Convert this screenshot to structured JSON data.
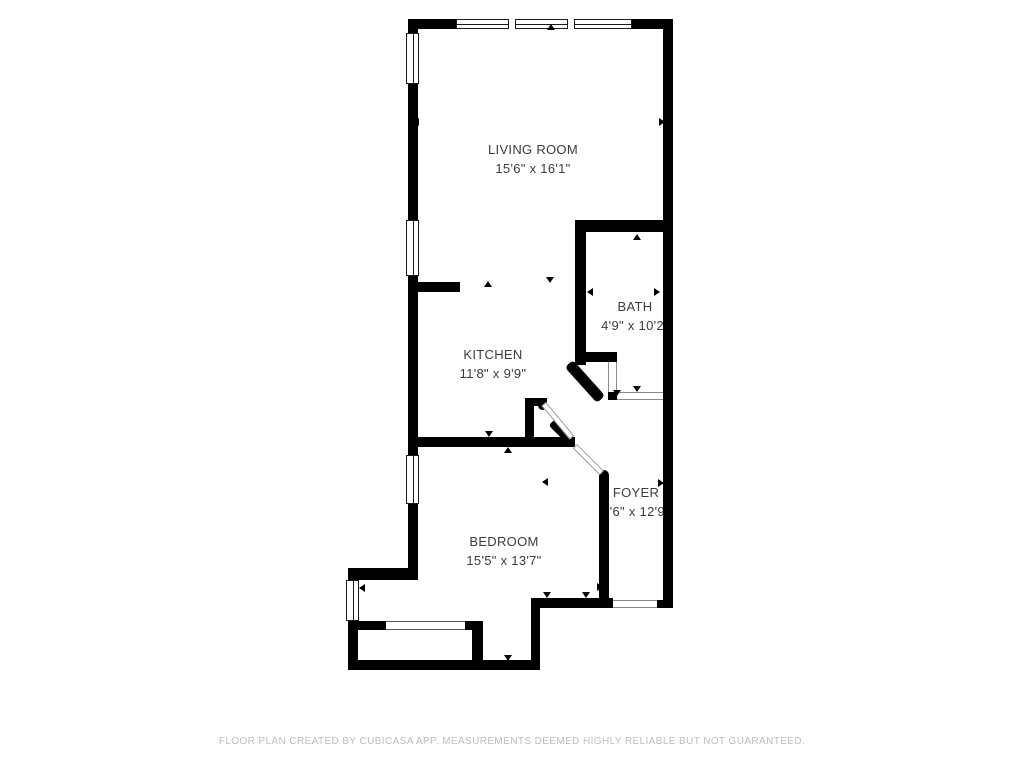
{
  "floor_plan": {
    "app_attribution": "CubiCasa",
    "rooms": [
      {
        "id": "living-room",
        "name": "LIVING ROOM",
        "dims": "15'6\" x 16'1\""
      },
      {
        "id": "kitchen",
        "name": "KITCHEN",
        "dims": "11'8\" x 9'9\""
      },
      {
        "id": "bath",
        "name": "BATH",
        "dims": "4'9\" x 10'2\""
      },
      {
        "id": "bedroom",
        "name": "BEDROOM",
        "dims": "15'5\" x 13'7\""
      },
      {
        "id": "foyer",
        "name": "FOYER",
        "dims": "7'6\" x 12'9\""
      }
    ],
    "footer_text": "FLOOR PLAN CREATED BY CUBICASA APP. MEASUREMENTS DEEMED HIGHLY RELIABLE BUT NOT GUARANTEED.",
    "colors": {
      "wall": "#000000",
      "background": "#ffffff",
      "label_text": "#3c3c3c",
      "footer_text": "#bdbdbd"
    }
  }
}
